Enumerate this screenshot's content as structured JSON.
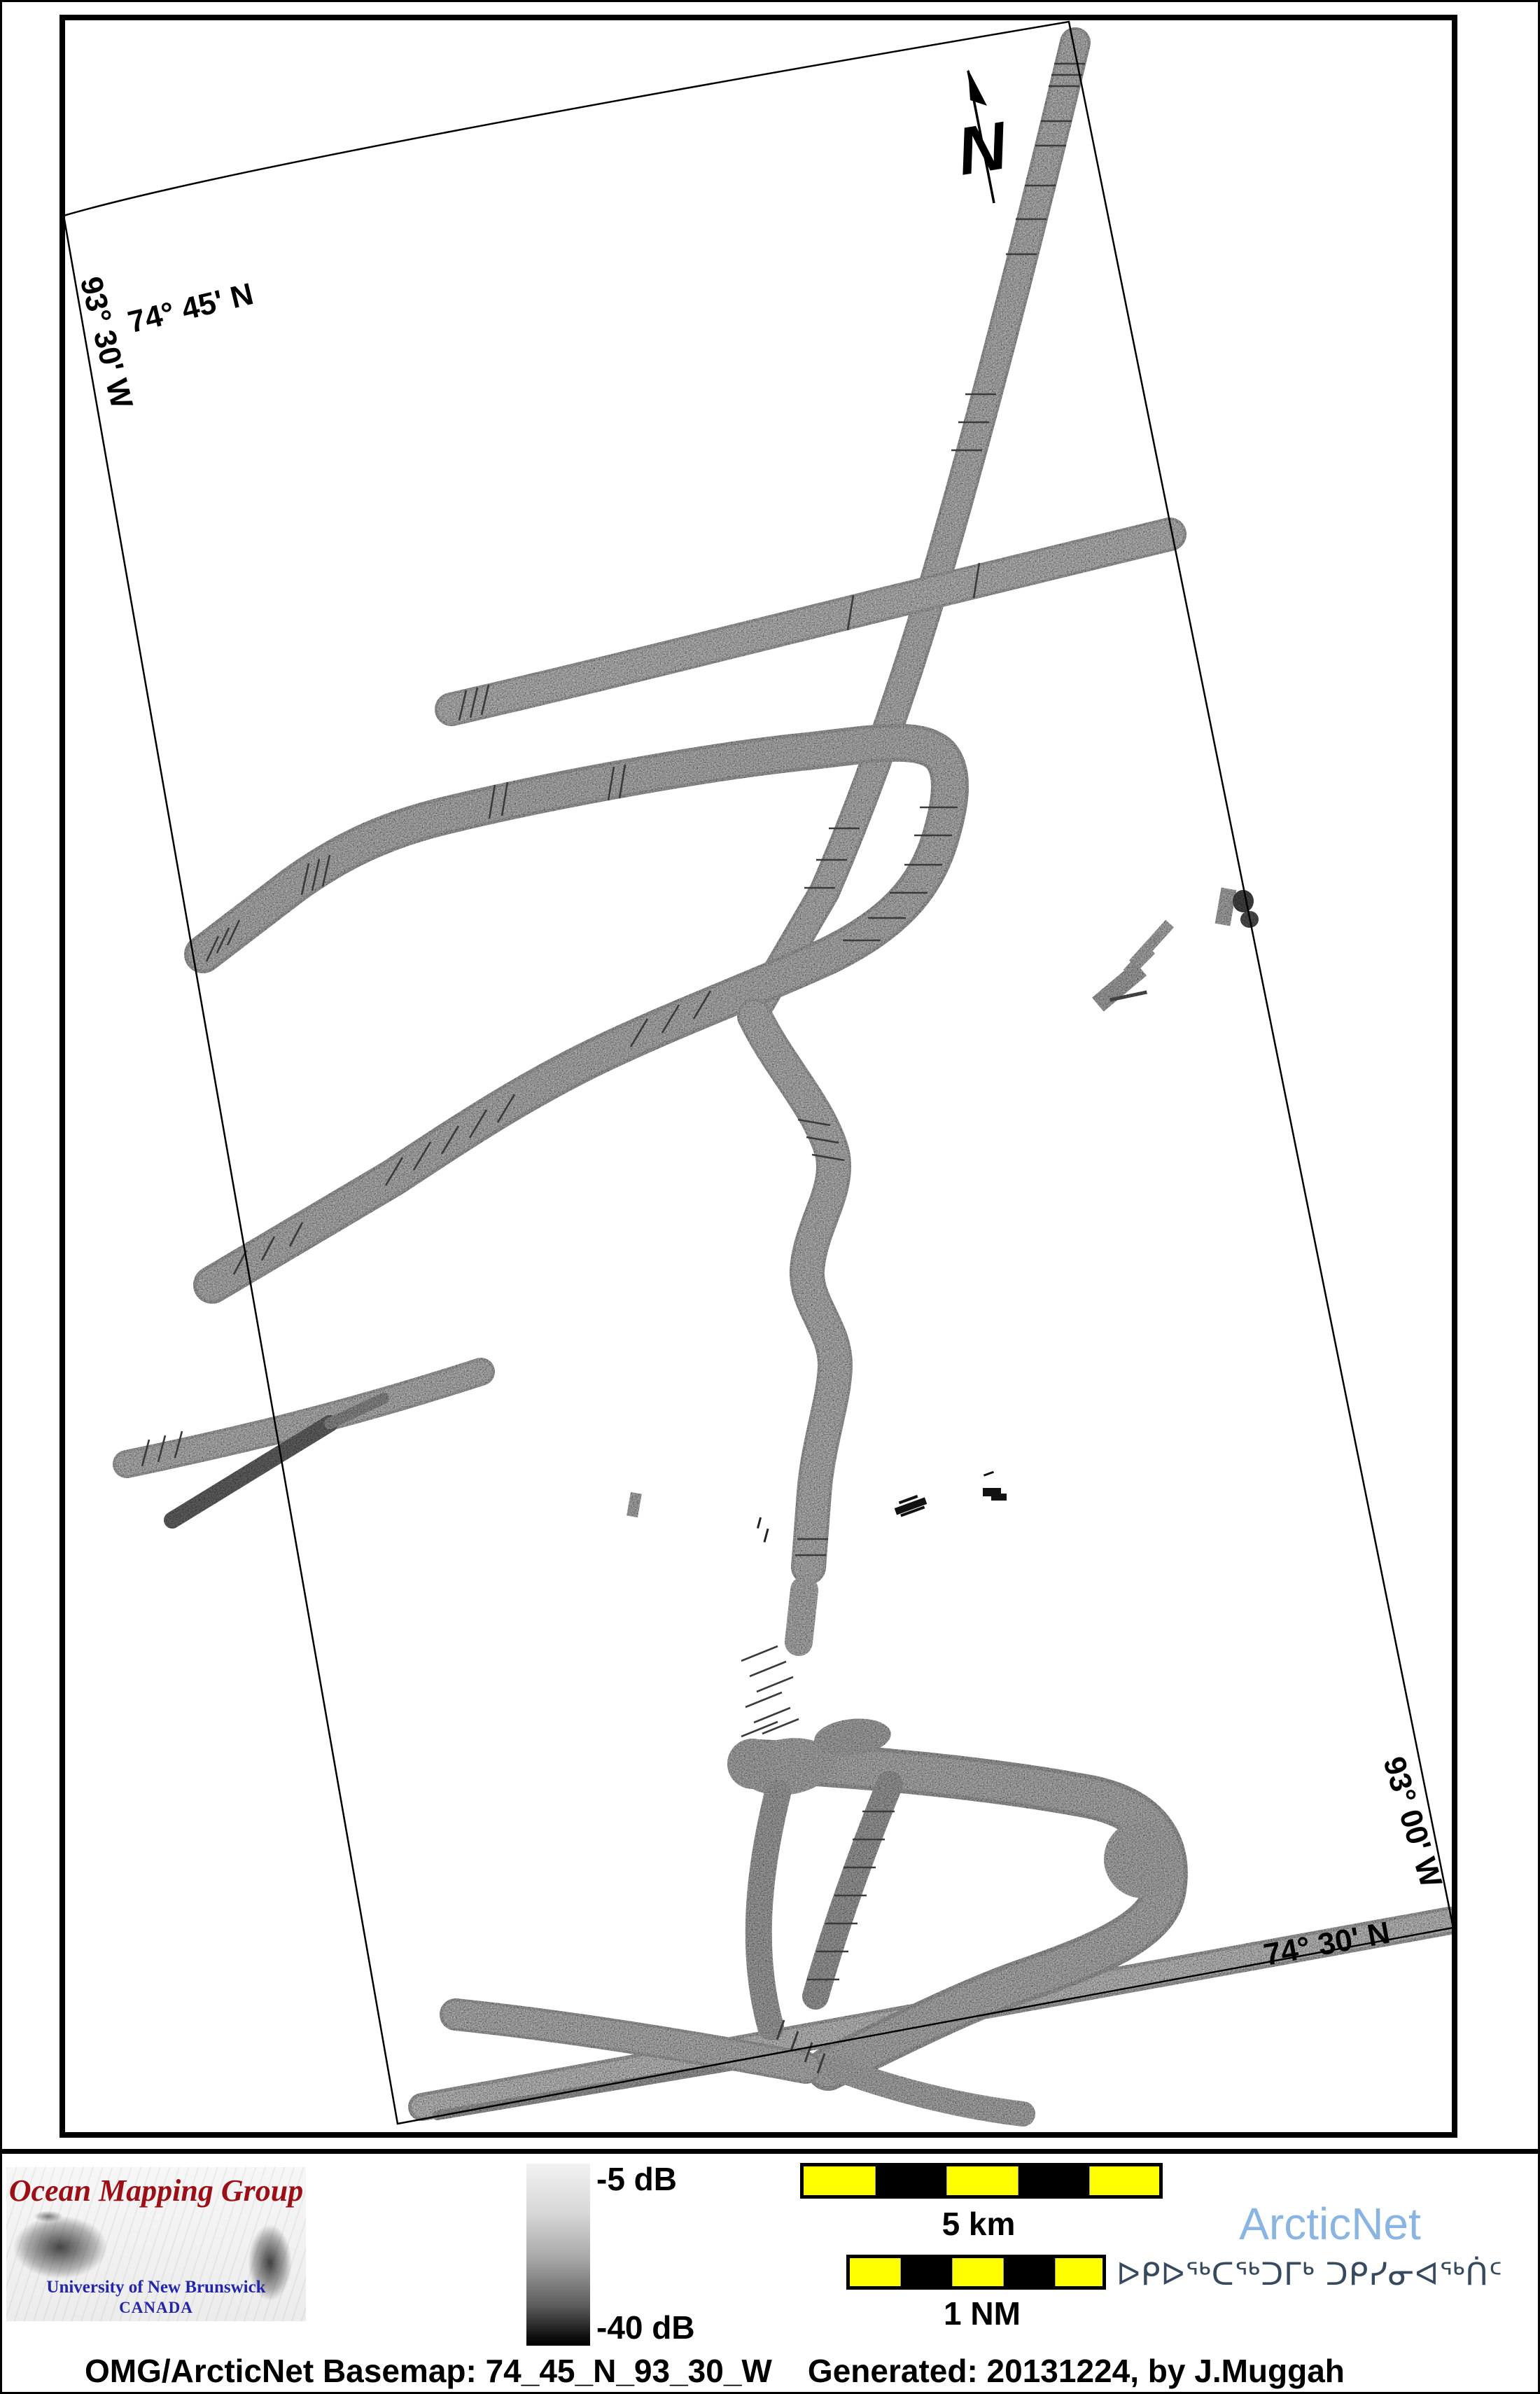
{
  "map": {
    "graticule_labels": {
      "top_lat": "74° 45' N",
      "left_lon": "93° 30' W",
      "right_lon": "93° 00' W",
      "bottom_lat": "74° 30' N"
    },
    "north_arrow_label": "N"
  },
  "legend": {
    "omg_logo": {
      "title": "Ocean Mapping Group",
      "institution": "University of New Brunswick",
      "country": "CANADA",
      "title_color": "#9b1016",
      "institution_color": "#2525a8"
    },
    "backscatter_colorbar": {
      "top_label": "-5 dB",
      "bottom_label": "-40 dB",
      "top_color": "#f2f2f2",
      "bottom_color": "#000000"
    },
    "scale_bars": {
      "km": {
        "label": "5 km",
        "segments": 5
      },
      "nm": {
        "label": "1 NM",
        "segments": 5
      },
      "segment_yellow": "#ffff00",
      "segment_black": "#000000"
    },
    "arcticnet": {
      "wordmark": "ArcticNet",
      "wordmark_color": "#8ab4e2",
      "inuktitut": "ᐅᑭᐅᖅᑕᖅᑐᒥᒃ ᑐᑭᓯᓂᐊᖅᑏᑦ",
      "inuktitut_color": "#36495e"
    }
  },
  "footer": {
    "text": "OMG/ArcticNet Basemap: 74_45_N_93_30_W    Generated: 20131224, by J.Muggah"
  }
}
